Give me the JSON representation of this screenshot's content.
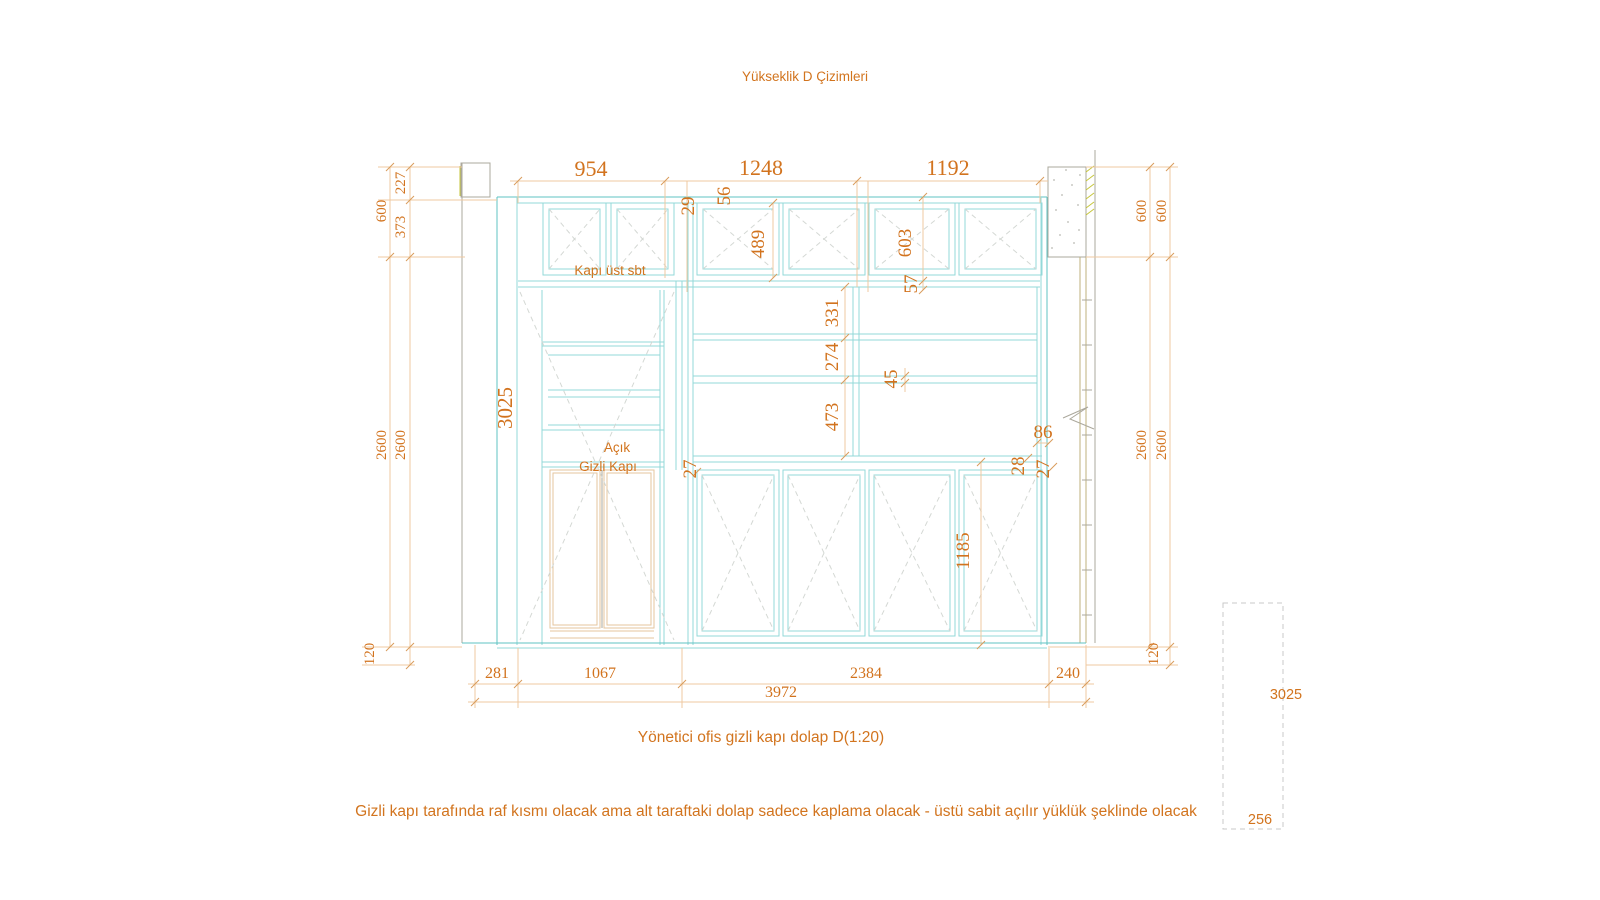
{
  "title": "Yükseklik D Çizimleri",
  "caption": "Yönetici ofis gizli kapı dolap  D(1:20)",
  "note": "Gizli kapı tarafında raf kısmı olacak ama alt taraftaki dolap sadece kaplama olacak - üstü sabit açılır yüklük şeklinde olacak",
  "labels": {
    "upper_door": "Kapı üst sbt",
    "open_shelf": "Açık",
    "hidden_door": "Gizli Kapı"
  },
  "dimensions": {
    "top": {
      "d954": "954",
      "d1248": "1248",
      "d1192": "1192"
    },
    "left": {
      "d600": "600",
      "d227": "227",
      "d373": "373",
      "d2600_a": "2600",
      "d2600_b": "2600",
      "d120": "120",
      "d3025": "3025"
    },
    "right": {
      "d600_a": "600",
      "d600_b": "600",
      "d2600_a": "2600",
      "d2600_b": "2600",
      "d120": "120"
    },
    "bottom": {
      "d281": "281",
      "d1067": "1067",
      "d2384": "2384",
      "d240": "240",
      "d3972": "3972"
    },
    "interior": {
      "d29": "29",
      "d56": "56",
      "d489": "489",
      "d603": "603",
      "d57": "57",
      "d331": "331",
      "d274": "274",
      "d45": "45",
      "d473": "473",
      "d27_rail": "27",
      "d86": "86",
      "d28": "28",
      "d27_right": "27",
      "d1185": "1185"
    }
  },
  "side_detail": {
    "d3025": "3025",
    "d256": "256"
  },
  "colors": {
    "accent_text": "#d2731e",
    "cabinet_line": "#93d9d9",
    "dim_line": "#efc9a0",
    "hidden_door_line": "#e5c69e",
    "wall_line": "#aba89c",
    "hatch": "#c6c63a",
    "swing_dash": "#d4d8d4"
  }
}
